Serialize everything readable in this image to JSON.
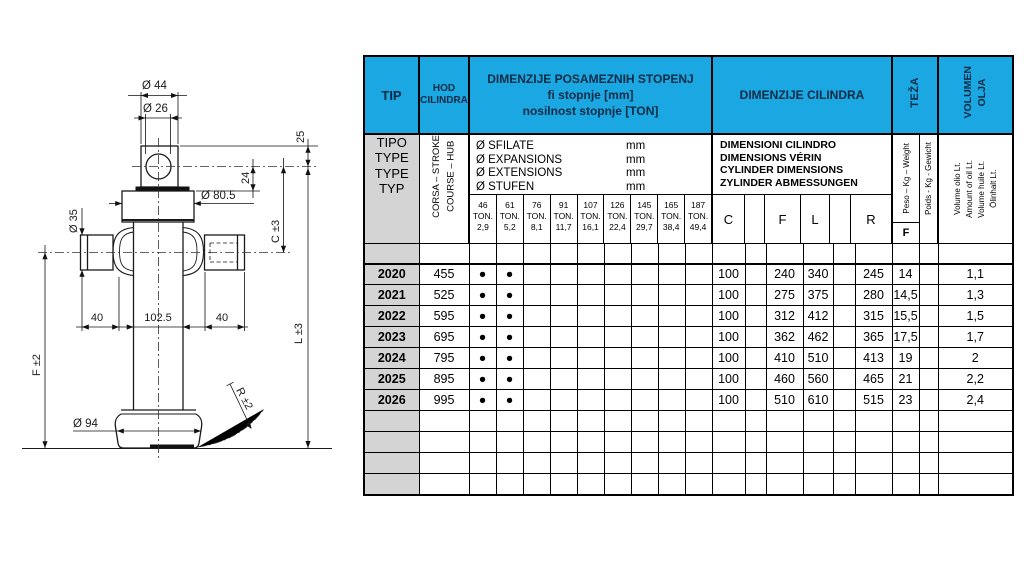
{
  "drawing": {
    "labels": {
      "dia_top": "Ø 44",
      "dia_hole": "Ø 26",
      "dim_25": "25",
      "dim_24": "24",
      "dia_collar": "Ø 80.5",
      "dim_c": "C ±3",
      "dia_pin": "Ø 35",
      "dim_40_left": "40",
      "dim_102_5": "102.5",
      "dim_40_right": "40",
      "dim_l": "L ±3",
      "dim_f": "F ±2",
      "dim_r": "R ±2",
      "dia_base": "Ø 94"
    }
  },
  "table": {
    "header": {
      "tip": "TIP",
      "hod": "HOD\nCILINDRA",
      "stage_title": "DIMENZIJE POSAMEZNIH STOPENJ\nfi stopnje [mm]\nnosilnost stopnje [TON]",
      "cylinder_title": "DIMENZIJE CILINDRA",
      "teza": "TEŽA",
      "volumen": "VOLUMEN\nOLJA"
    },
    "subheader": {
      "tipo": "TIPO\nTYPE\nTYPE\nTYP",
      "corsa": "CORSA – STROKE\nCOURSE – HUB",
      "stage_lines": [
        {
          "label": "Ø SFILATE",
          "unit": "mm"
        },
        {
          "label": "Ø EXPANSIONS",
          "unit": "mm"
        },
        {
          "label": "Ø EXTENSIONS",
          "unit": "mm"
        },
        {
          "label": "Ø STUFEN",
          "unit": "mm"
        }
      ],
      "ton_columns": [
        {
          "fi": "46",
          "mid": "TON.",
          "ton": "2,9"
        },
        {
          "fi": "61",
          "mid": "TON.",
          "ton": "5,2"
        },
        {
          "fi": "76",
          "mid": "TON.",
          "ton": "8,1"
        },
        {
          "fi": "91",
          "mid": "TON.",
          "ton": "11,7"
        },
        {
          "fi": "107",
          "mid": "TON.",
          "ton": "16,1"
        },
        {
          "fi": "126",
          "mid": "TON.",
          "ton": "22,4"
        },
        {
          "fi": "145",
          "mid": "TON.",
          "ton": "29,7"
        },
        {
          "fi": "165",
          "mid": "TON.",
          "ton": "38,4"
        },
        {
          "fi": "187",
          "mid": "TON.",
          "ton": "49,4"
        }
      ],
      "cylinder_lines": [
        "DIMENSIONI CILINDRO",
        "DIMENSIONS VÉRIN",
        "CYLINDER DIMENSIONS",
        "ZYLINDER ABMESSUNGEN"
      ],
      "cylinder_cols": [
        "C",
        "",
        "F",
        "L",
        "",
        "R"
      ],
      "weight_rot_1": "Peso – Kg – Weight",
      "weight_rot_2": "Poids - Kg - Gewicht",
      "weight_sub": "F",
      "volume_rot": "Volume olio Lt.\nAmount of oil Lt.\nVolume huile Lt.\nÖlinhalt Lt."
    },
    "dot": "●",
    "rows": [
      {
        "tip": "2020",
        "stroke": "455",
        "dots": 2,
        "c": "100",
        "f": "240",
        "l": "340",
        "r": "245",
        "weight": "14",
        "oil": "1,1"
      },
      {
        "tip": "2021",
        "stroke": "525",
        "dots": 2,
        "c": "100",
        "f": "275",
        "l": "375",
        "r": "280",
        "weight": "14,5",
        "oil": "1,3"
      },
      {
        "tip": "2022",
        "stroke": "595",
        "dots": 2,
        "c": "100",
        "f": "312",
        "l": "412",
        "r": "315",
        "weight": "15,5",
        "oil": "1,5"
      },
      {
        "tip": "2023",
        "stroke": "695",
        "dots": 2,
        "c": "100",
        "f": "362",
        "l": "462",
        "r": "365",
        "weight": "17,5",
        "oil": "1,7"
      },
      {
        "tip": "2024",
        "stroke": "795",
        "dots": 2,
        "c": "100",
        "f": "410",
        "l": "510",
        "r": "413",
        "weight": "19",
        "oil": "2"
      },
      {
        "tip": "2025",
        "stroke": "895",
        "dots": 2,
        "c": "100",
        "f": "460",
        "l": "560",
        "r": "465",
        "weight": "21",
        "oil": "2,2"
      },
      {
        "tip": "2026",
        "stroke": "995",
        "dots": 2,
        "c": "100",
        "f": "510",
        "l": "610",
        "r": "515",
        "weight": "23",
        "oil": "2,4"
      }
    ],
    "empty_rows": 4
  },
  "colors": {
    "header_blue": "#1BA7E1",
    "header_text": "#0D2B45",
    "row_gray": "#D4D4D4"
  }
}
